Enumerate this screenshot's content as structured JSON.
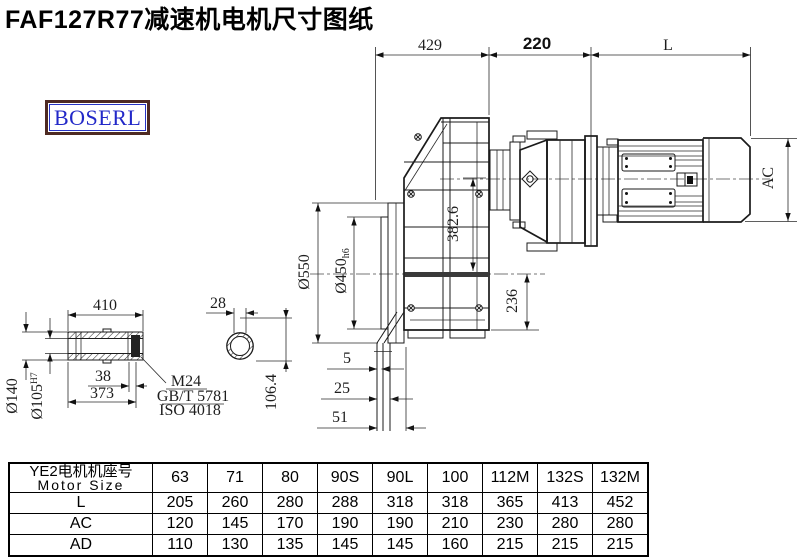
{
  "title": "FAF127R77减速机电机尺寸图纸",
  "logo": {
    "text": "BOSERL",
    "border_color": "#4e2a22",
    "text_color": "#2228c8"
  },
  "drawing": {
    "dims": {
      "top_left": "429",
      "top_mid": "220",
      "top_right": "L",
      "motor_ac": "AC",
      "flange_od": "Ø550",
      "spigot_d": "Ø450",
      "spigot_tol": "h6",
      "height_382": "382.6",
      "height_236": "236",
      "off_5": "5",
      "off_25": "25",
      "off_51": "51"
    },
    "shaft": {
      "len_410": "410",
      "key_28": "28",
      "od_140": "Ø140",
      "bore_105": "Ø105",
      "bore_tol": "H7",
      "d38": "38",
      "d373": "373",
      "d106": "106.4",
      "bolt": "M24",
      "std_gb": "GB/T 5781",
      "std_iso": "ISO 4018"
    }
  },
  "table": {
    "header_cn": "YE2电机机座号",
    "header_en": "Motor Size",
    "columns": [
      "63",
      "71",
      "80",
      "90S",
      "90L",
      "100",
      "112M",
      "132S",
      "132M"
    ],
    "rows": [
      {
        "label": "L",
        "values": [
          "205",
          "260",
          "280",
          "288",
          "318",
          "318",
          "365",
          "413",
          "452"
        ]
      },
      {
        "label": "AC",
        "values": [
          "120",
          "145",
          "170",
          "190",
          "190",
          "210",
          "230",
          "280",
          "280"
        ]
      },
      {
        "label": "AD",
        "values": [
          "110",
          "130",
          "135",
          "145",
          "145",
          "160",
          "215",
          "215",
          "215"
        ]
      }
    ]
  }
}
